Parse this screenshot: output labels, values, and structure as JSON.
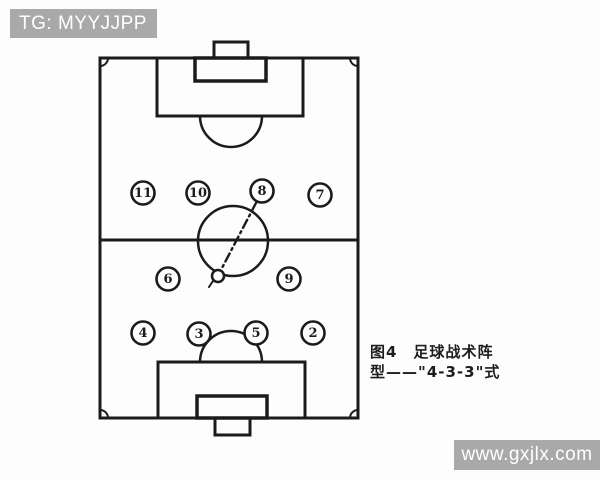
{
  "watermarks": {
    "top_left": "TG: MYYJJPP",
    "bottom_right": "www.gxjlx.com"
  },
  "caption": {
    "figure_label": "图4",
    "line1": "图4　足球战术阵",
    "line2": "型——\"4-3-3\"式",
    "formation": "4-3-3"
  },
  "pitch": {
    "players": [
      {
        "number": "11",
        "x": 143,
        "y": 193
      },
      {
        "number": "10",
        "x": 198,
        "y": 193
      },
      {
        "number": "8",
        "x": 262,
        "y": 191
      },
      {
        "number": "7",
        "x": 320,
        "y": 195
      },
      {
        "number": "6",
        "x": 168,
        "y": 279
      },
      {
        "number": "9",
        "x": 289,
        "y": 279
      },
      {
        "number": "4",
        "x": 143,
        "y": 333
      },
      {
        "number": "3",
        "x": 199,
        "y": 334
      },
      {
        "number": "5",
        "x": 256,
        "y": 333
      },
      {
        "number": "2",
        "x": 313,
        "y": 333
      }
    ]
  },
  "colors": {
    "ink": "#1b1b1b",
    "watermark_bg": "#a9a9a9",
    "watermark_text": "#ffffff",
    "paper": "#fdfdfd"
  }
}
